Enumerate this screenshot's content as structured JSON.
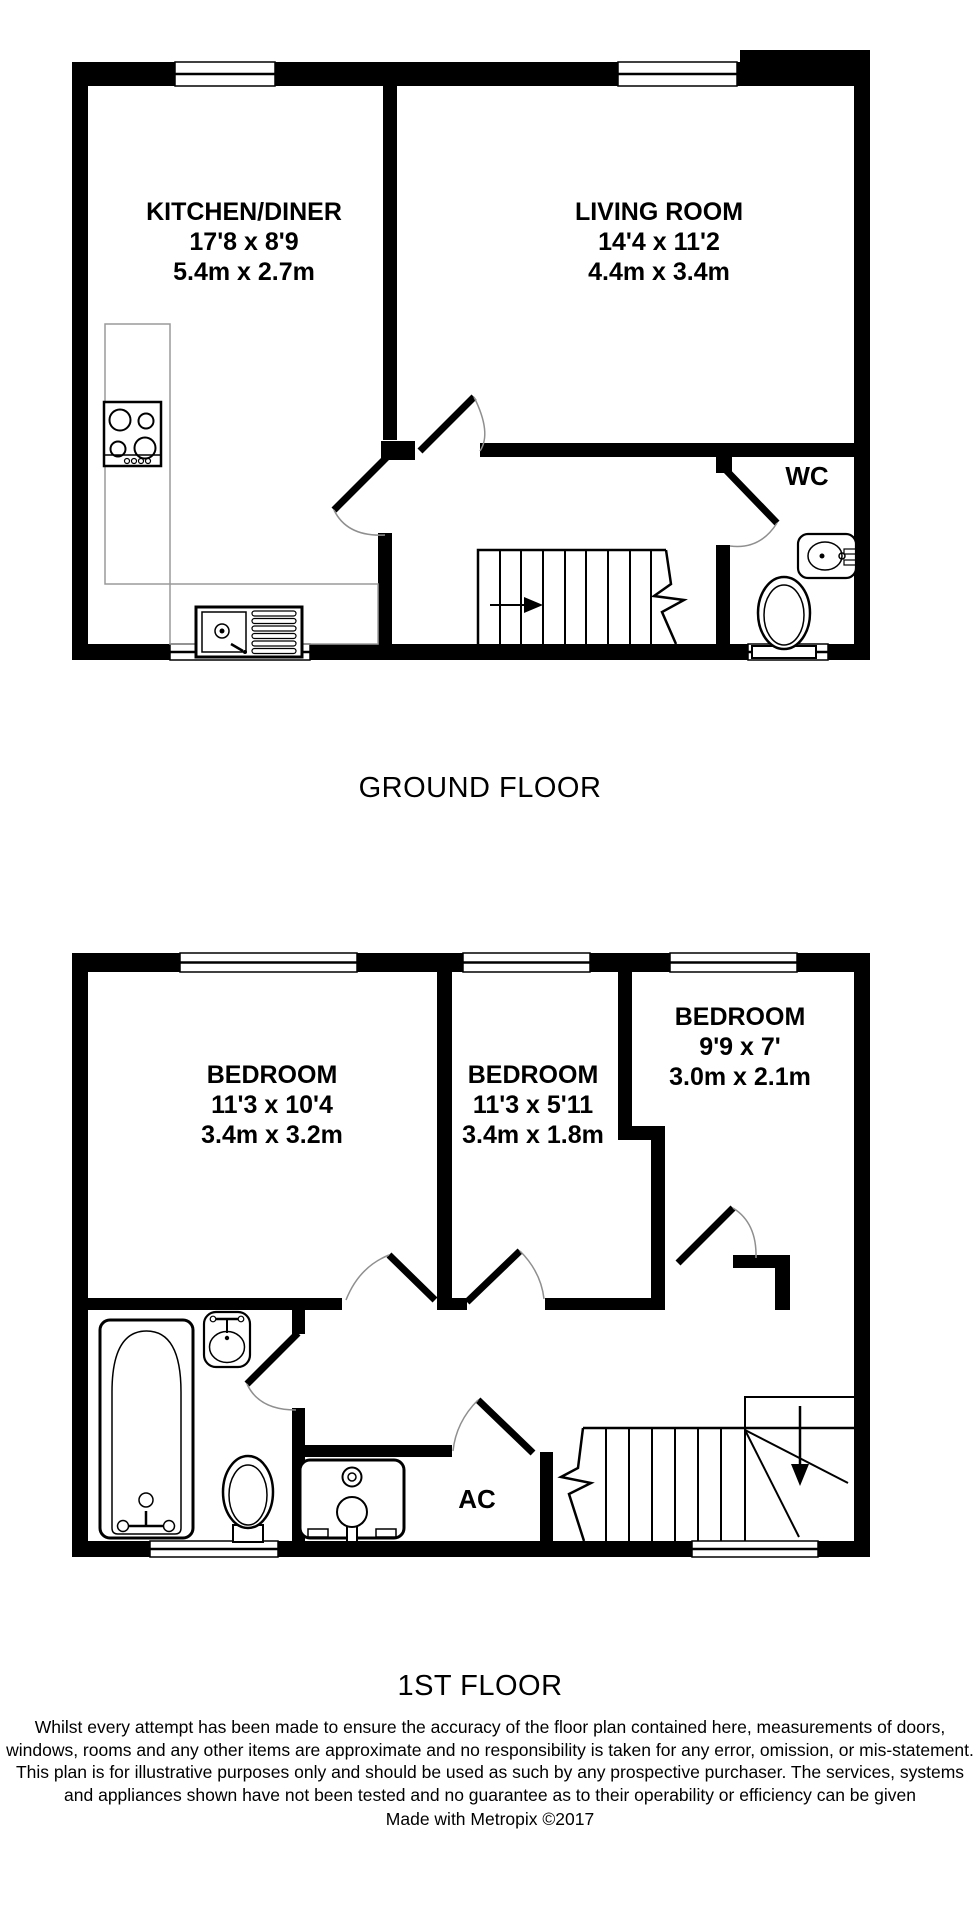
{
  "ground_floor": {
    "title": "GROUND FLOOR",
    "rooms": [
      {
        "name": "KITCHEN/DINER",
        "imperial": "17'8 x 8'9",
        "metric": "5.4m x 2.7m"
      },
      {
        "name": "LIVING ROOM",
        "imperial": "14'4 x 11'2",
        "metric": "4.4m x 3.4m"
      },
      {
        "name": "WC"
      }
    ]
  },
  "first_floor": {
    "title": "1ST FLOOR",
    "rooms": [
      {
        "name": "BEDROOM",
        "imperial": "11'3 x 10'4",
        "metric": "3.4m x 3.2m"
      },
      {
        "name": "BEDROOM",
        "imperial": "11'3 x 5'11",
        "metric": "3.4m x 1.8m"
      },
      {
        "name": "BEDROOM",
        "imperial": "9'9 x 7'",
        "metric": "3.0m x 2.1m"
      },
      {
        "name": "AC"
      }
    ]
  },
  "footer": {
    "disclaimer": "Whilst every attempt has been made to ensure the accuracy of the floor plan contained here, measurements of doors, windows, rooms and any other items are approximate and no responsibility is taken for any error, omission, or mis-statement. This plan is for illustrative purposes only and should be used as such by any prospective purchaser. The services, systems and appliances shown have not been tested and no guarantee as to their operability or efficiency can be given",
    "credit": "Made with Metropix ©2017"
  },
  "colors": {
    "wall": "#000000",
    "background": "#ffffff",
    "door_arc": "#8f8f8f"
  }
}
